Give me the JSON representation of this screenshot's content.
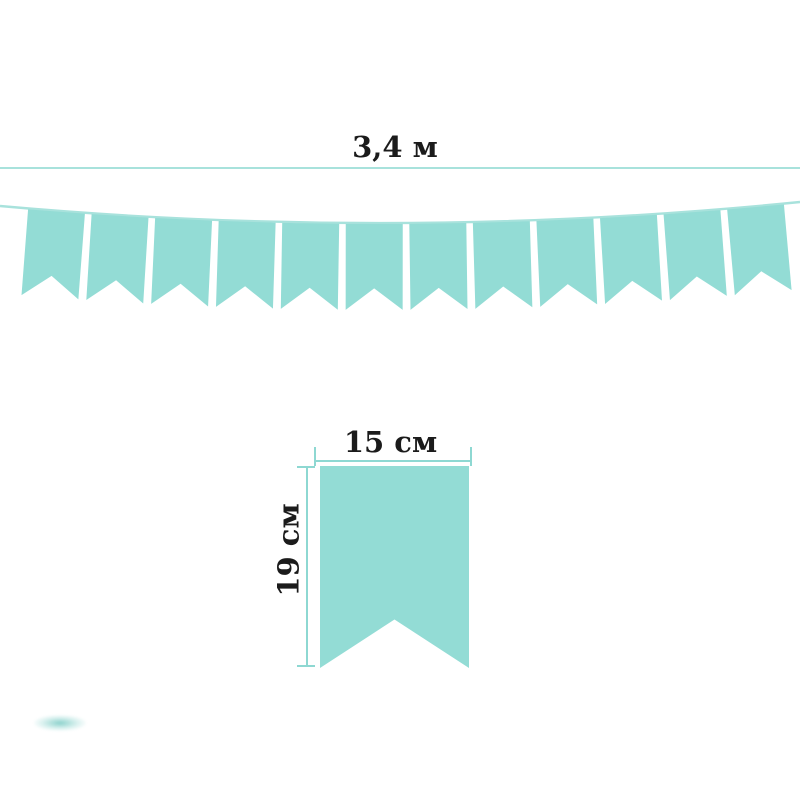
{
  "page": {
    "background_color": "#ffffff",
    "text_color": "#1b1b1b"
  },
  "diagram": {
    "total_length": {
      "label": "3,4 м",
      "line_color": "#a8e2dc"
    },
    "garland": {
      "flag_count": 12,
      "flag_color": "#93dcd5",
      "string_color": "#a8e2dc"
    },
    "single_flag": {
      "width_label": "15 см",
      "height_label": "19 см",
      "flag_color": "#93dcd5",
      "measure_color": "#8ed8d2"
    }
  }
}
